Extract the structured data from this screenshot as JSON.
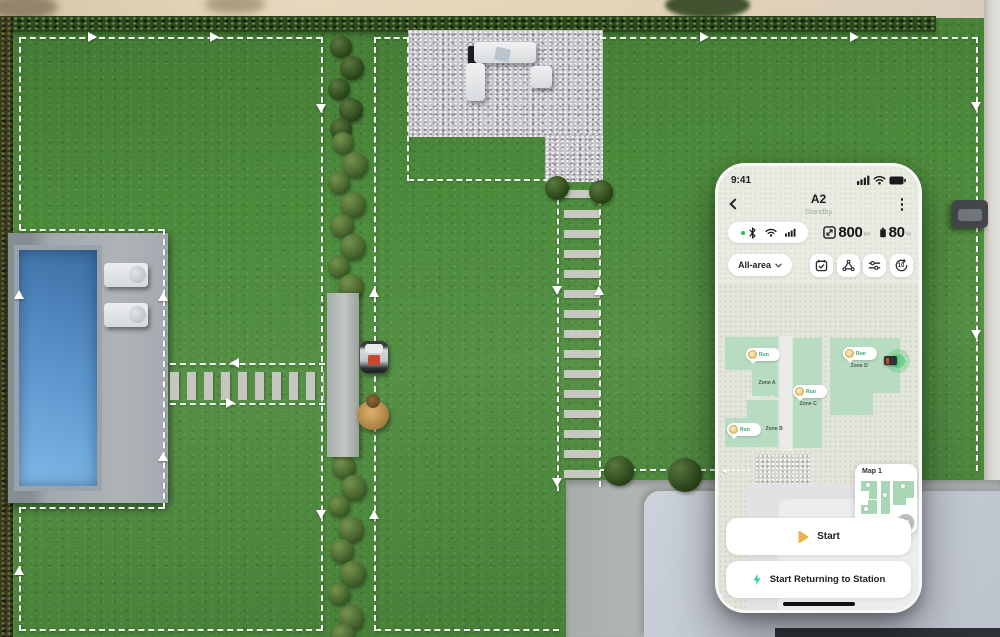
{
  "phone": {
    "status_bar": {
      "time": "9:41"
    },
    "header": {
      "title": "A2",
      "subtitle": "Standby"
    },
    "stats": {
      "area_value": "800",
      "area_unit": "m²",
      "battery_value": "80",
      "battery_unit": "%"
    },
    "mode": {
      "selected": "All-area"
    },
    "controls": {
      "rotate_label": "10"
    },
    "map": {
      "zones": [
        {
          "label": "Zone A",
          "badge": "Run"
        },
        {
          "label": "Zone B",
          "badge": "Run"
        },
        {
          "label": "Zone C",
          "badge": "Run"
        },
        {
          "label": "Zone D",
          "badge": "Run"
        }
      ],
      "card_label": "Map 1"
    },
    "actions": {
      "start_label": "Start",
      "return_label": "Start Returning to Station"
    }
  },
  "icons": {
    "status": [
      "signal-bars-icon",
      "wifi-icon",
      "battery-icon"
    ],
    "connectivity": [
      "bluetooth-icon",
      "wifi-icon",
      "signal-bars-icon"
    ],
    "control_buttons": [
      "calendar-check-icon",
      "zone-triangle-icon",
      "sliders-icon",
      "rotate-10-icon"
    ],
    "action_buttons": [
      "play-icon",
      "lightning-icon"
    ]
  },
  "scene": {
    "colors": {
      "lawn": "#4c8a3b",
      "hedge": "#2c471d",
      "boundary_line": "#ffffff",
      "pool_water": "#5b94cc",
      "pool_deck": "#a2a8ae",
      "gravel": "#c9c7cc",
      "driveway": "#b6bbbc",
      "platform": "#c5cbd5",
      "accent_gold": "#e9b34c",
      "accent_teal": "#35d09c",
      "zone_fill": "#b7dcc1",
      "screen_bg": "#e9ece2"
    }
  }
}
